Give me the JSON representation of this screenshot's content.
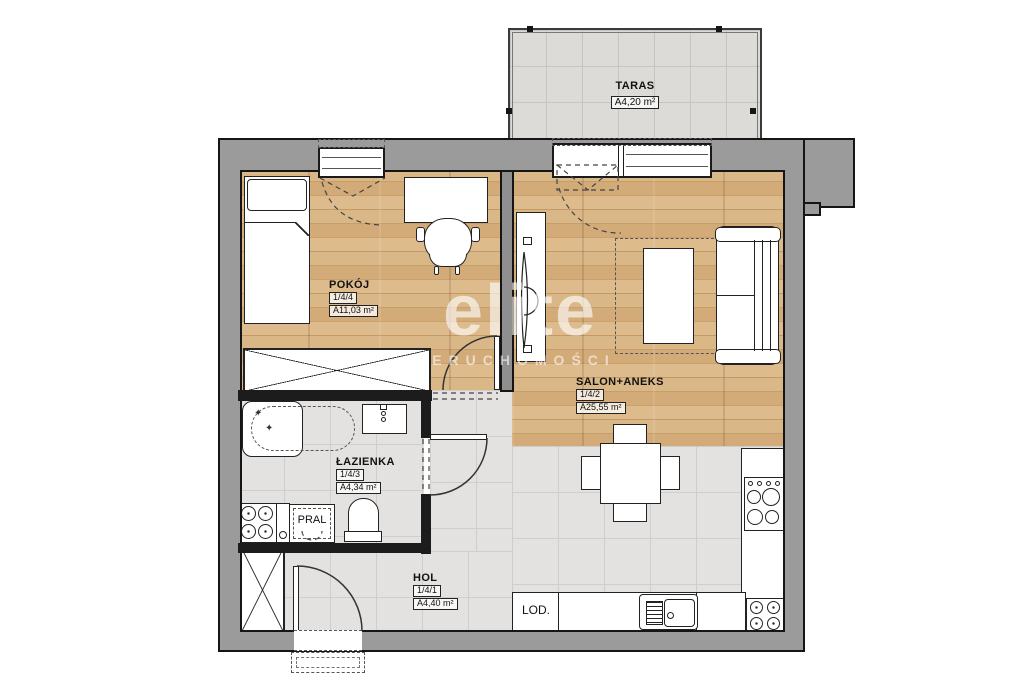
{
  "watermark": {
    "brand": "elite",
    "subtitle": "NIERUCHOMOŚCI"
  },
  "rooms": {
    "taras": {
      "name": "TARAS",
      "area": "A4,20 m²"
    },
    "pokoj": {
      "name": "POKÓJ",
      "unit": "1/4/4",
      "area": "A11,03 m²"
    },
    "salon": {
      "name": "SALON+ANEKS",
      "unit": "1/4/2",
      "area": "A25,55 m²"
    },
    "lazienka": {
      "name": "ŁAZIENKA",
      "unit": "1/4/3",
      "area": "A4,34 m²"
    },
    "hol": {
      "name": "HOL",
      "unit": "1/4/1",
      "area": "A4,40 m²"
    }
  },
  "appliances": {
    "washing_machine": "PRAL",
    "fridge": "LOD."
  },
  "icons": {
    "jet": "✦"
  },
  "colors": {
    "wall_outer": "#9b9b9b",
    "wall_inner": "#1c1c1c",
    "wood": "#d3ab7a",
    "tile": "#e3e2e0",
    "line": "#222222",
    "watermark": "#ffffff"
  }
}
